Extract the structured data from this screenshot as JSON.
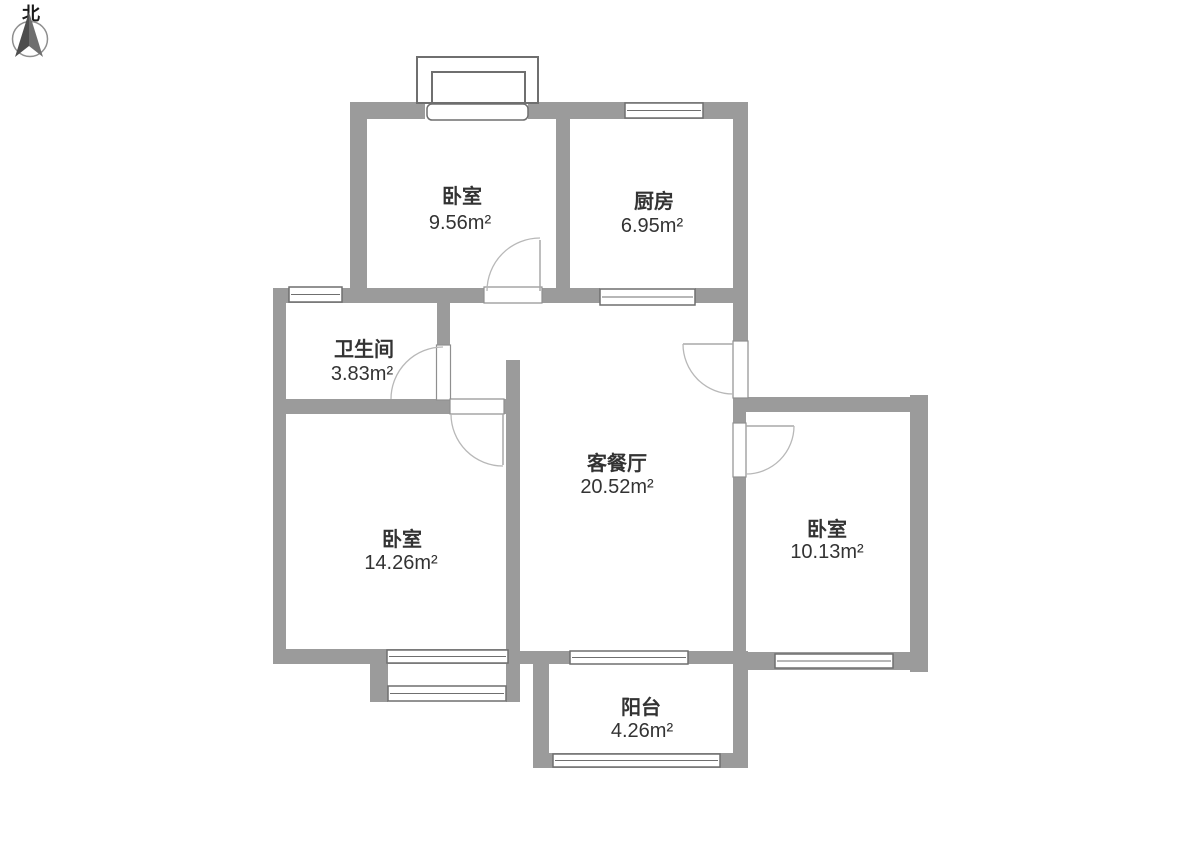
{
  "compass": {
    "label": "北"
  },
  "rooms": [
    {
      "key": "bedroom-top",
      "name": "卧室",
      "area": "9.56m²"
    },
    {
      "key": "kitchen",
      "name": "厨房",
      "area": "6.95m²"
    },
    {
      "key": "bathroom",
      "name": "卫生间",
      "area": "3.83m²"
    },
    {
      "key": "living-dining",
      "name": "客餐厅",
      "area": "20.52m²"
    },
    {
      "key": "bedroom-left",
      "name": "卧室",
      "area": "14.26m²"
    },
    {
      "key": "bedroom-right",
      "name": "卧室",
      "area": "10.13m²"
    },
    {
      "key": "balcony",
      "name": "阳台",
      "area": "4.26m²"
    }
  ],
  "colors": {
    "wall": "#9b9b9b",
    "frame": "#6f6f6f",
    "label_text": "#333333",
    "background": "#ffffff"
  }
}
